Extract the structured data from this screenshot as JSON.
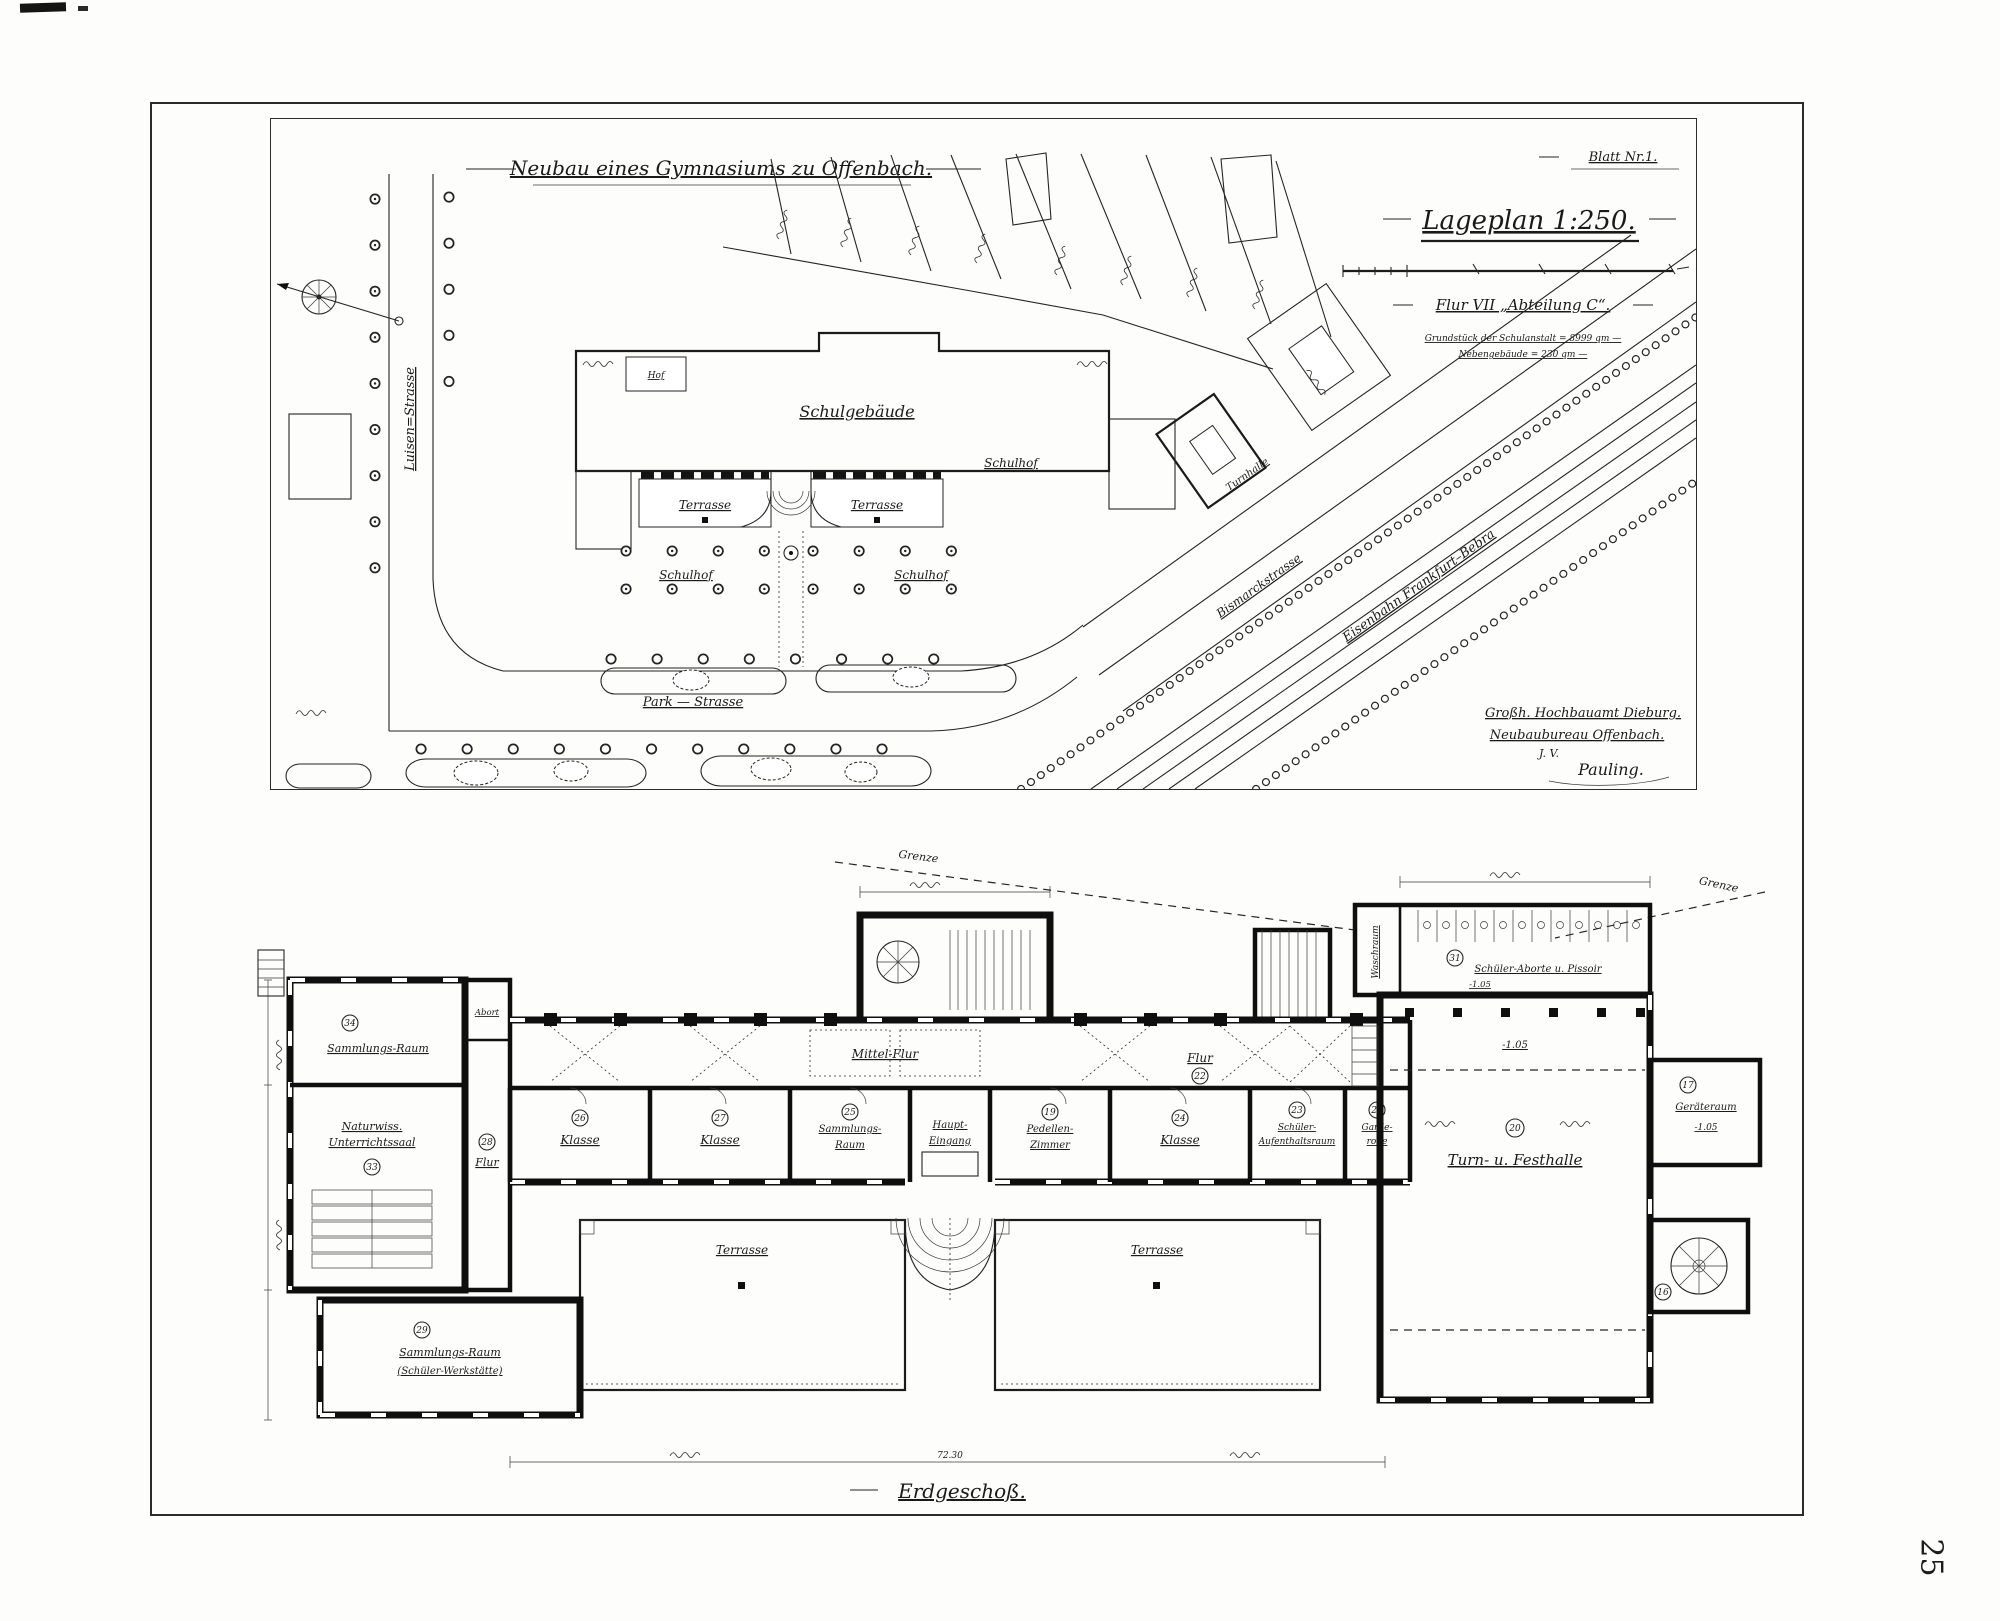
{
  "page": {
    "number": "25"
  },
  "plate": {
    "title": "Neubau eines Gymnasiums zu Offenbach.",
    "sheet_no": "Blatt Nr.1."
  },
  "siteplan": {
    "title": "Lageplan 1:250.",
    "section_line": "Flur VII „Abteilung C“.",
    "note1": "Grundstück der Schulanstalt = 8999 qm —",
    "note2": "Nebengebäude = 230 qm —",
    "streets": {
      "luisen": "Luisen=Strasse",
      "park": "Park — Strasse",
      "bismarck": "Bismarckstrasse",
      "railway": "Eisenbahn Frankfurt–Bebra"
    },
    "labels": {
      "schulgebaeude": "Schulgebäude",
      "terrasse_left": "Terrasse",
      "terrasse_right": "Terrasse",
      "schulhof_left": "Schulhof",
      "schulhof_mid": "Schulhof",
      "schulhof_right": "Schulhof",
      "turnhalle": "Turnhalle",
      "hof": "Hof"
    },
    "signature": {
      "line1": "Großh. Hochbauamt Dieburg.",
      "line2": "Neubaubureau Offenbach.",
      "line3": "J. V.",
      "line4": "Pauling."
    }
  },
  "floorplan": {
    "title": "Erdgeschoß.",
    "grenze_left": "Grenze",
    "grenze_right": "Grenze",
    "overall_dim": "72.30",
    "corridor": {
      "flur_left": "Flur",
      "flur_left_no": "28",
      "mittel": "Mittel-Flur",
      "flur_right": "Flur",
      "flur_right_no": "22"
    },
    "rooms": {
      "sammlung_top": {
        "no": "34",
        "label": "Sammlungs-Raum"
      },
      "naturwiss": {
        "no": "33",
        "line1": "Naturwiss.",
        "line2": "Unterrichtssaal"
      },
      "abort": {
        "label": "Abort"
      },
      "klasse1": {
        "no": "26",
        "label": "Klasse"
      },
      "klasse2": {
        "no": "27",
        "label": "Klasse"
      },
      "sammlung_mid": {
        "no": "25",
        "line1": "Sammlungs-",
        "line2": "Raum"
      },
      "eingang": {
        "line1": "Haupt-",
        "line2": "Eingang"
      },
      "pedell": {
        "no": "19",
        "line1": "Pedellen-",
        "line2": "Zimmer"
      },
      "klasse3": {
        "no": "24",
        "label": "Klasse"
      },
      "aufenthalt": {
        "no": "23",
        "line1": "Schüler-",
        "line2": "Aufenthaltsraum"
      },
      "garderobe": {
        "no": "21",
        "line1": "Garde-",
        "line2": "robe"
      },
      "halle": {
        "no": "20",
        "label": "Turn- u. Festhalle",
        "level": "-1.05"
      },
      "geraete": {
        "no": "17",
        "label": "Geräteraum",
        "level": "-1.05"
      },
      "stair_round": {
        "no": "16"
      },
      "aborte": {
        "no": "31",
        "label": "Schüler-Aborte u. Pissoir",
        "level": "-1.05"
      },
      "waschraum": {
        "label": "Waschraum"
      },
      "terrasse_left": "Terrasse",
      "terrasse_right": "Terrasse",
      "werkstatt": {
        "no": "29",
        "line1": "Sammlungs-Raum",
        "line2": "(Schüler-Werkstätte)"
      }
    }
  }
}
